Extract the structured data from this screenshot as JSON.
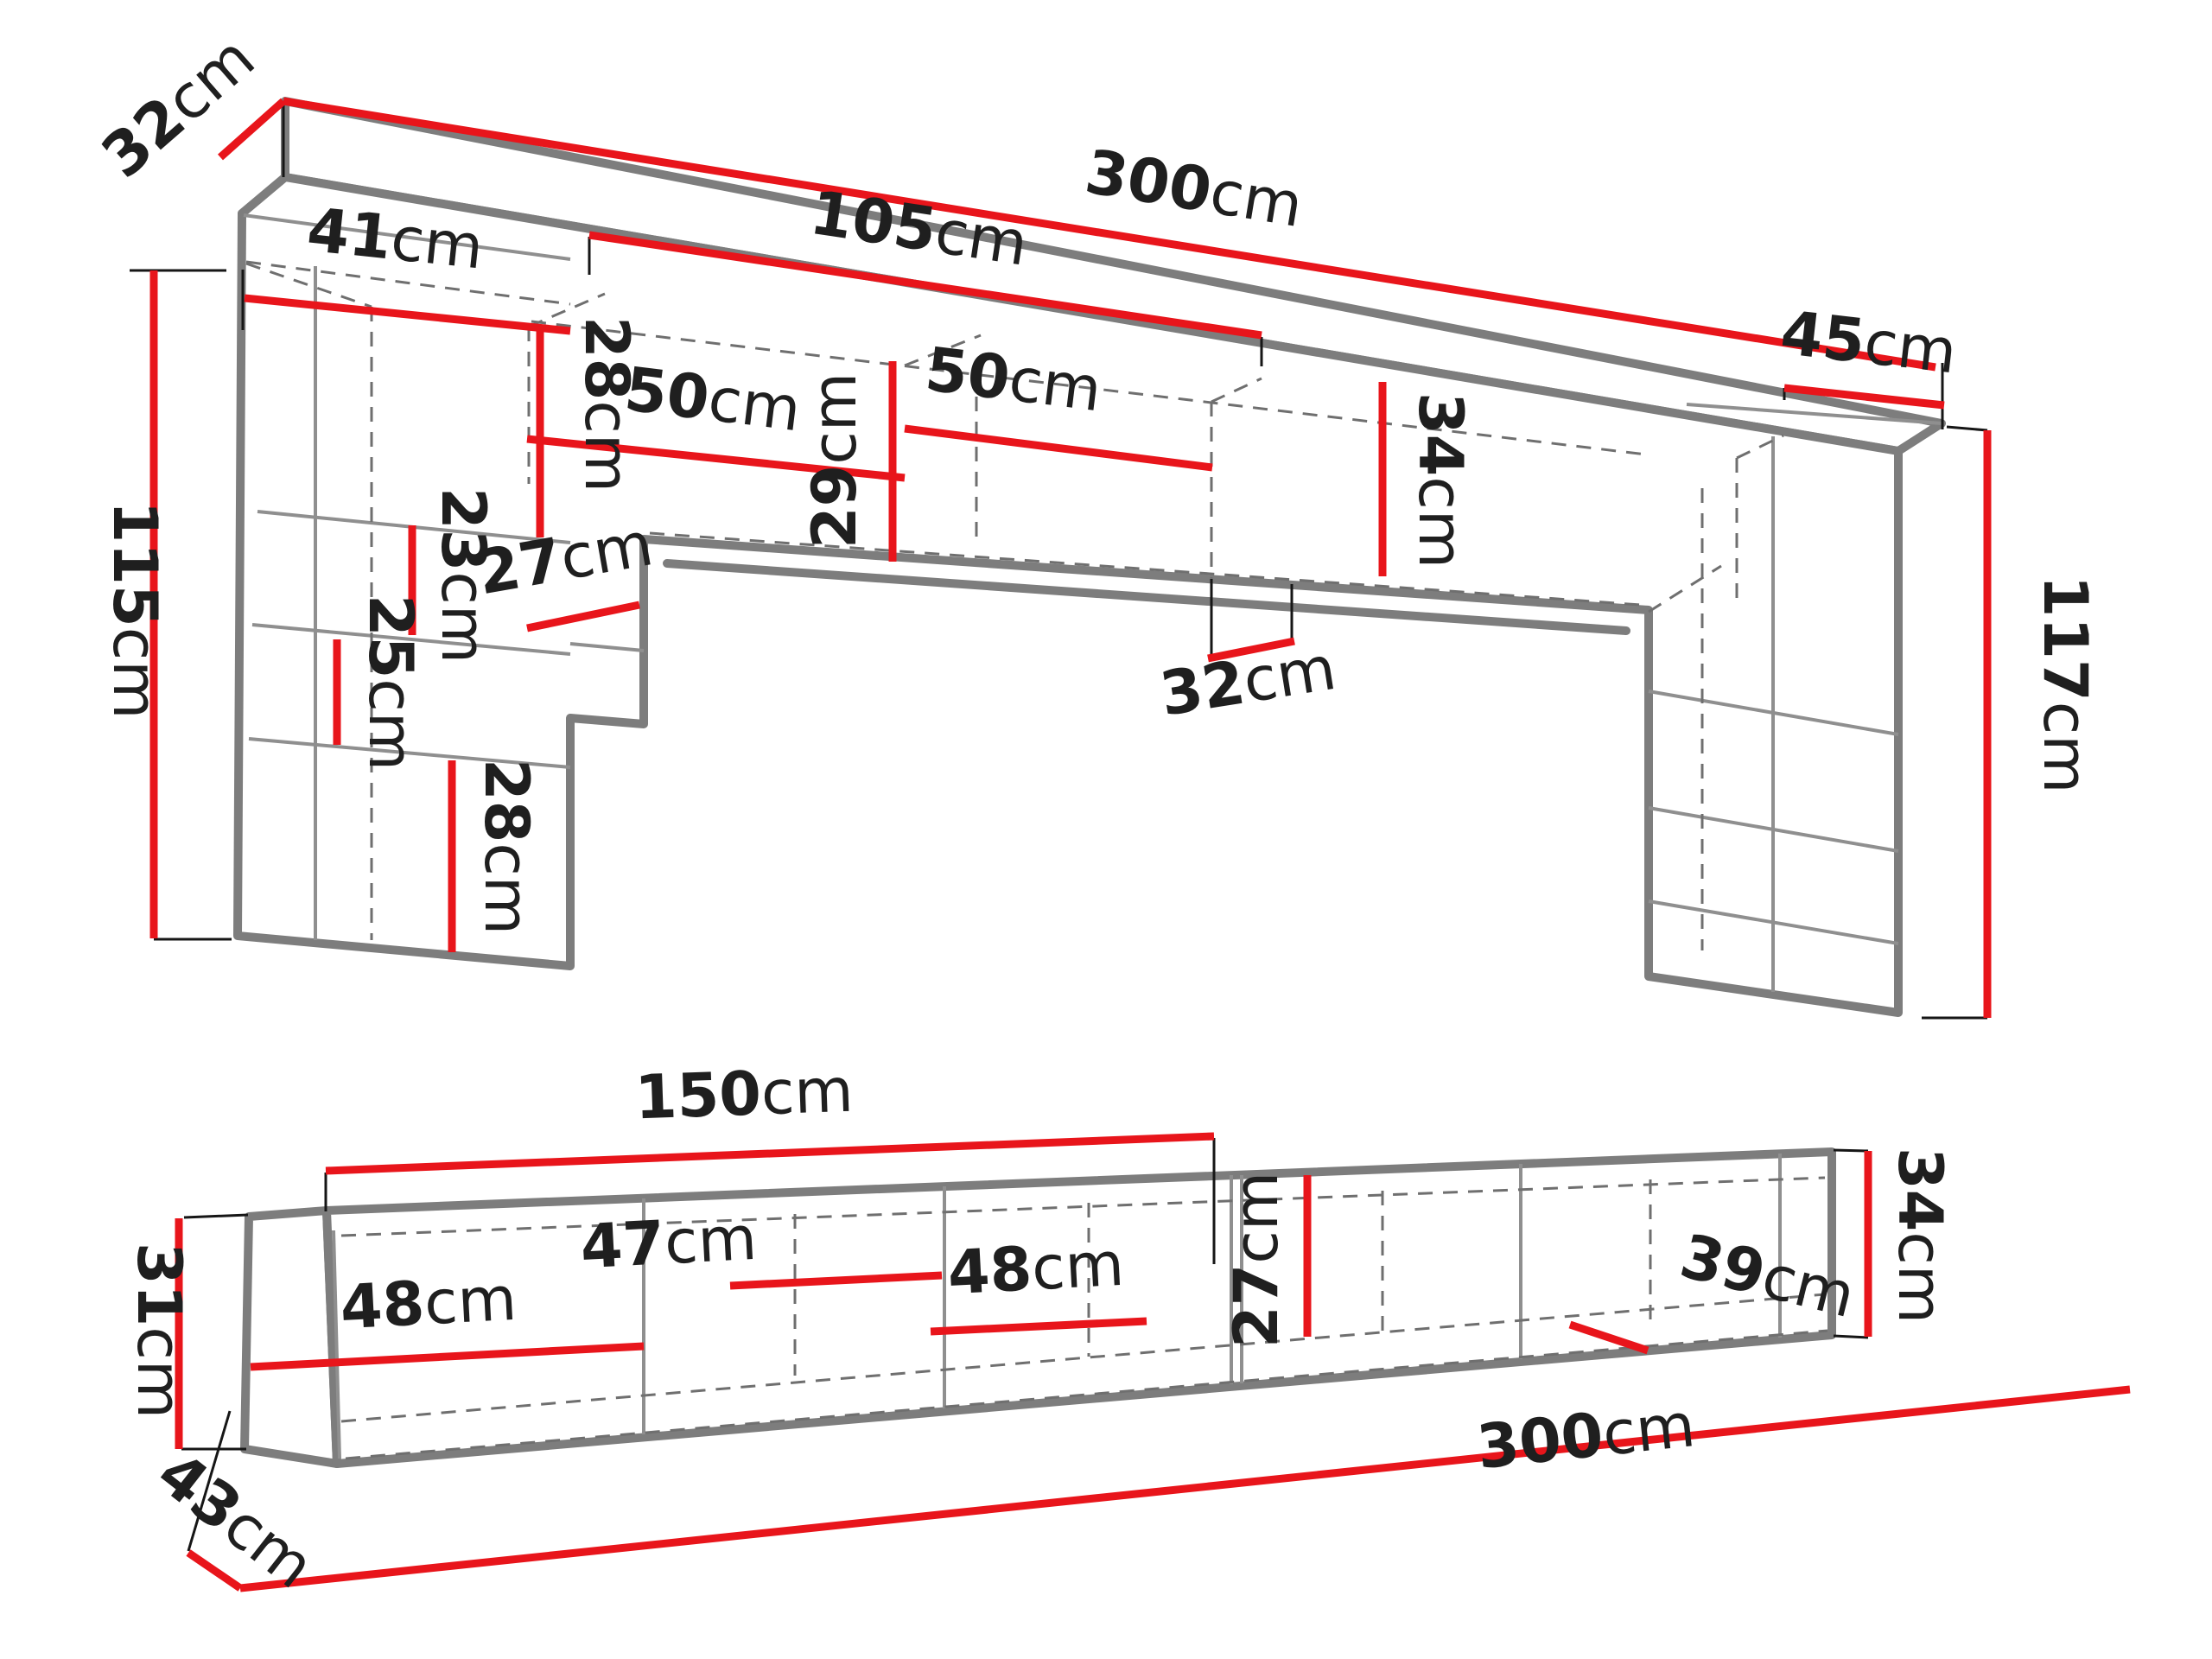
{
  "top_unit": {
    "depth_top": "32cm",
    "width_total": "300cm",
    "opening_width": "105cm",
    "left_col_width": "41cm",
    "shelf_top": "28cm",
    "comp_left": "50cm",
    "bridge_height": "29cm",
    "comp_right": "50cm",
    "inner_height": "34cm",
    "right_col_width": "45cm",
    "shelf_a": "23cm",
    "shelf_depth": "27cm",
    "shelf_b": "25cm",
    "shelf_c": "28cm",
    "bottom_depth": "32cm",
    "left_height": "115cm",
    "right_height": "117cm"
  },
  "bottom_unit": {
    "left_width": "150cm",
    "left_height": "31cm",
    "comp_1": "48cm",
    "comp_2": "47cm",
    "comp_3": "48cm",
    "inner_height": "27cm",
    "comp_4": "39cm",
    "right_height": "34cm",
    "total_width": "300cm",
    "depth": "43cm"
  },
  "colors": {
    "dimension_red": "#e8151b",
    "outline_gray": "#7d7d7d",
    "label_black": "#1f1f1f",
    "background": "#ffffff"
  }
}
